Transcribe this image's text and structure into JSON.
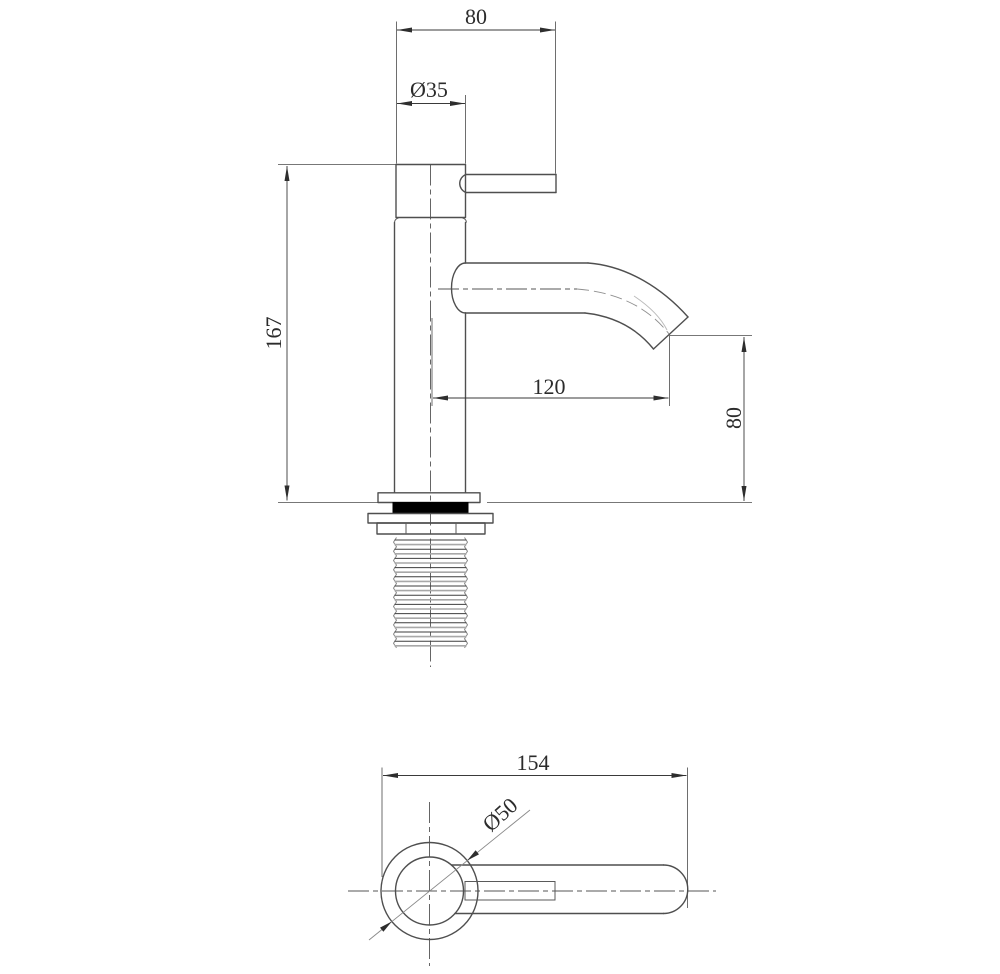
{
  "drawing": {
    "type": "technical-drawing",
    "subject": "single-lever basin faucet, side elevation and plan view",
    "colors": {
      "background": "#ffffff",
      "outline": "#4f4f4f",
      "dimension": "#3a3a3a",
      "centerline": "#555555",
      "thread_light": "#a8a8a8",
      "gasket_fill": "#000000"
    }
  },
  "side_view": {
    "dims": {
      "top_width": "80",
      "cap_diameter": "Ø35",
      "height": "167",
      "spout_reach": "120",
      "spout_height": "80"
    }
  },
  "plan_view": {
    "dims": {
      "overall_length": "154",
      "flange_diameter": "Ø50"
    }
  }
}
